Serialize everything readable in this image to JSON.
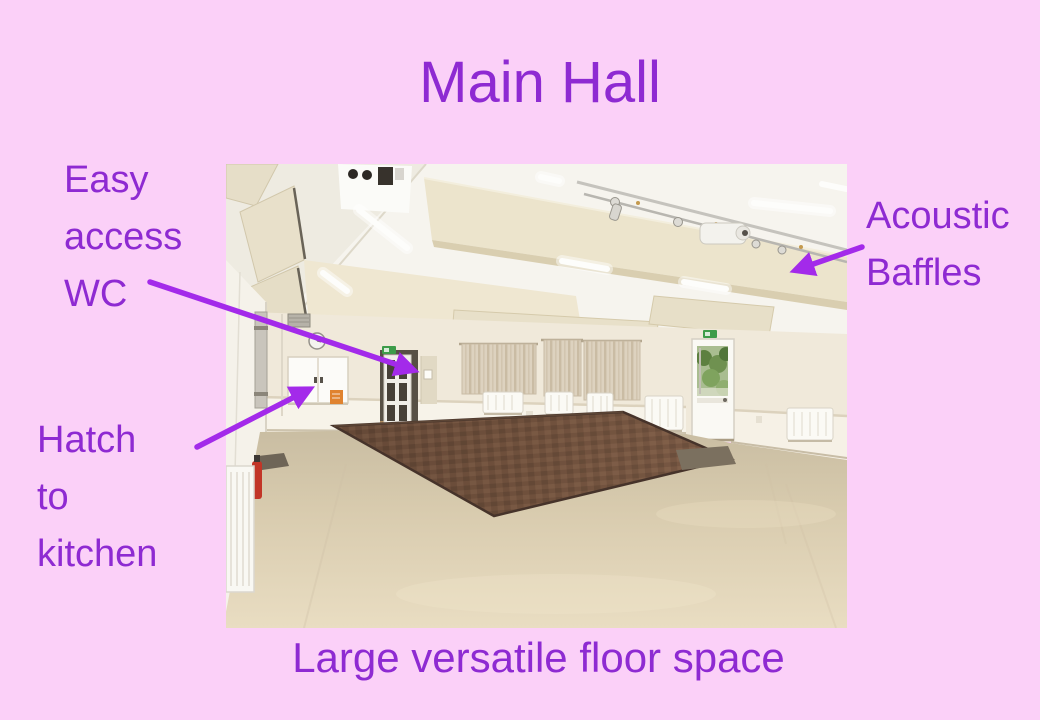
{
  "slide": {
    "title": "Main Hall",
    "caption": "Large versatile floor space",
    "annotations": {
      "wc": {
        "text": "Easy\naccess\nWC"
      },
      "baffles": {
        "text": "Acoustic\nBaffles"
      },
      "hatch": {
        "text": "Hatch\nto\nkitchen"
      }
    }
  },
  "colors": {
    "background": "#fbd0f8",
    "text_purple": "#8e2ad2",
    "arrow_purple": "#a32aea"
  }
}
